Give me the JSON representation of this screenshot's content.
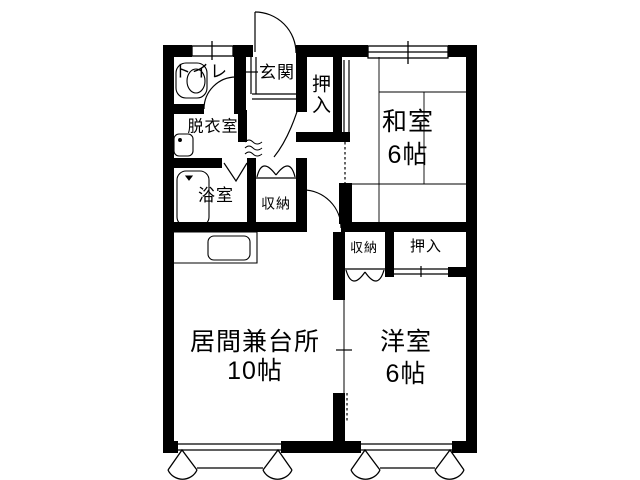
{
  "floorplan": {
    "title": "apartment-floor-plan",
    "colors": {
      "wall": "#000000",
      "background": "#ffffff",
      "text": "#000000"
    },
    "rooms": {
      "toilet": {
        "label": "トイレ"
      },
      "entrance": {
        "label": "玄関"
      },
      "closet_top": {
        "label": "押入"
      },
      "dressing_room": {
        "label": "脱衣室"
      },
      "bathroom": {
        "label": "浴室"
      },
      "storage_hall": {
        "label": "収納"
      },
      "japanese_room": {
        "label": "和室",
        "size": "6帖"
      },
      "storage_mid": {
        "label": "収納"
      },
      "closet_mid": {
        "label": "押入"
      },
      "living_kitchen": {
        "label": "居間兼台所",
        "size": "10帖"
      },
      "western_room": {
        "label": "洋室",
        "size": "6帖"
      }
    }
  }
}
